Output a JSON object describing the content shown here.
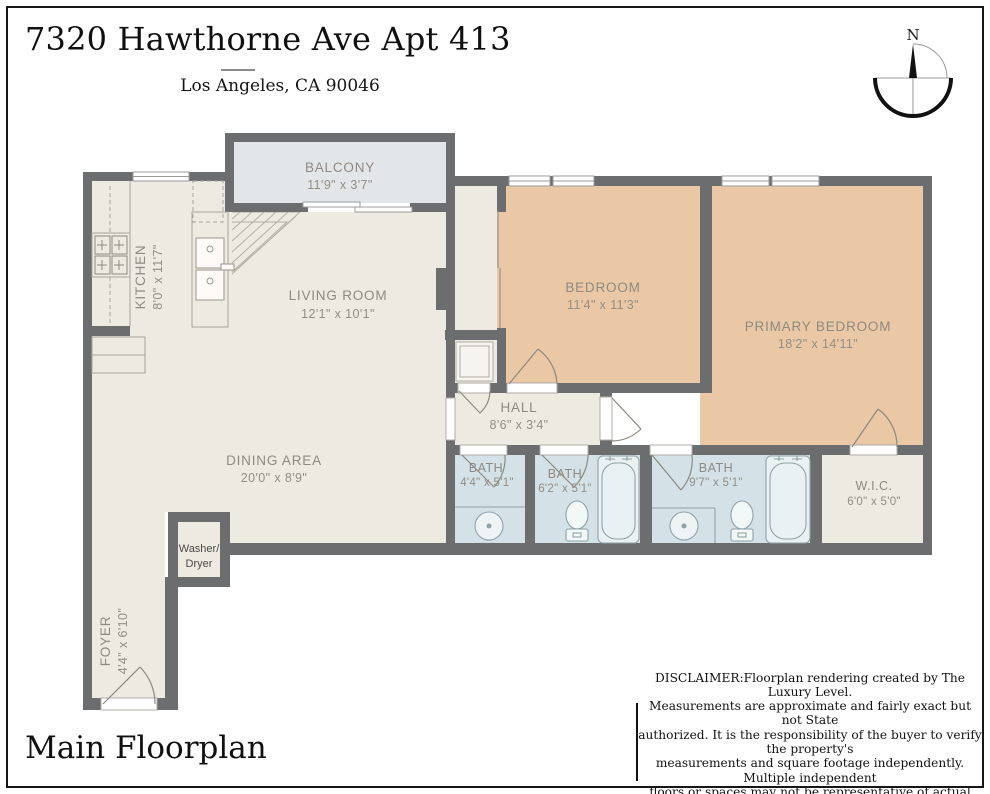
{
  "header": {
    "title": "7320 Hawthorne Ave Apt 413",
    "subtitle": "Los Angeles, CA 90046"
  },
  "footer": {
    "plan_label": "Main Floorplan",
    "disclaimer_lines": [
      "DISCLAIMER:Floorplan rendering created by The Luxury Level.",
      "Measurements are approximate and fairly exact but not State",
      "authorized. It is the responsibility of the buyer to verify the property's",
      "measurements and square footage independently.  Multiple independent",
      "floors or spaces may not be representative of actual location on property."
    ]
  },
  "compass": {
    "north_label": "N"
  },
  "rooms": {
    "balcony": {
      "name": "BALCONY",
      "dims": "11'9\" x 3'7\""
    },
    "kitchen": {
      "name": "KITCHEN",
      "dims": "8'0\" x 11'7\""
    },
    "living_room": {
      "name": "LIVING ROOM",
      "dims": "12'1\" x 10'1\""
    },
    "bedroom": {
      "name": "BEDROOM",
      "dims": "11'4\" x 11'3\""
    },
    "primary_bedroom": {
      "name": "PRIMARY BEDROOM",
      "dims": "18'2\" x 14'11\""
    },
    "hall": {
      "name": "HALL",
      "dims": "8'6\" x 3'4\""
    },
    "bath_1": {
      "name": "BATH",
      "dims": "4'4\" x 5'1\""
    },
    "bath_2": {
      "name": "BATH",
      "dims": "6'2\" x 5'1\""
    },
    "bath_3": {
      "name": "BATH",
      "dims": "9'7\" x 5'1\""
    },
    "wic": {
      "name": "W.I.C.",
      "dims": "6'0\" x 5'0\""
    },
    "dining_area": {
      "name": "DINING AREA",
      "dims": "20'0\" x 8'9\""
    },
    "foyer": {
      "name": "FOYER",
      "dims": "4'4\" x 6'10\""
    },
    "washer_dryer": {
      "line1": "Washer/",
      "line2": "Dryer"
    }
  },
  "colors": {
    "wall": "#6c6d6f",
    "floor_cream": "#edeae2",
    "bedroom_tan": "#eac8a5",
    "bath_blue": "#d4e1e6",
    "balcony_gray": "#e3e6e9",
    "label_gray": "#8e8a82",
    "frame_black": "#161616"
  }
}
